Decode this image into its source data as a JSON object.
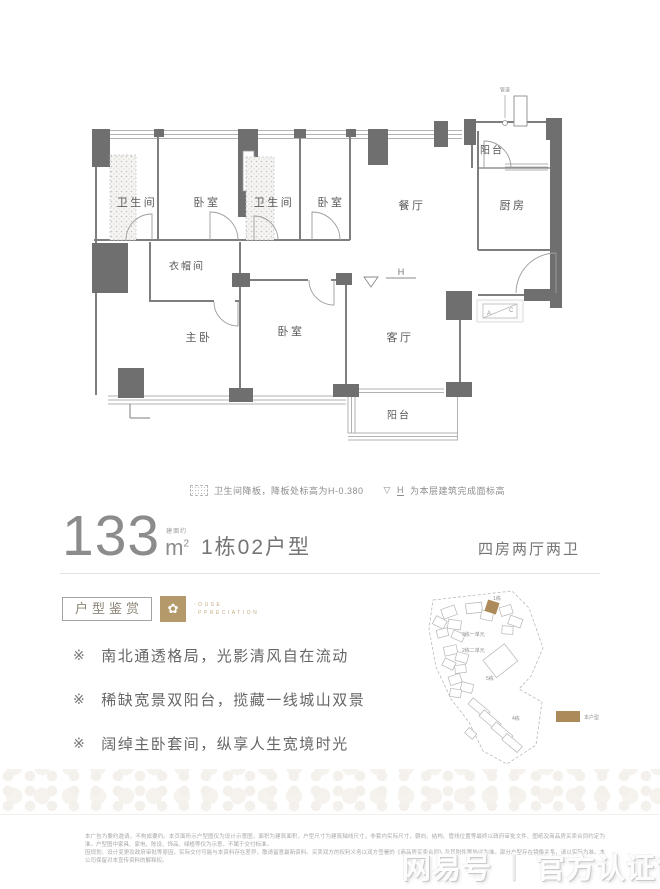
{
  "floorplan": {
    "rooms": [
      "卫生间",
      "卧室",
      "卫生间",
      "卧室",
      "餐厅",
      "厨房",
      "阳台",
      "衣帽间",
      "主卧",
      "卧室",
      "客厅",
      "阳台"
    ],
    "pipe_label": "管道",
    "h_label": "H",
    "ac_a": "A",
    "ac_c": "C",
    "legend": {
      "note1": "卫生间降板，降板处标高为H-0.380",
      "triangle_glyph": "▽",
      "note2_h": "H",
      "note2": "为本层建筑完成面标高"
    }
  },
  "title": {
    "area_value": "133",
    "area_prefix": "建面约",
    "area_unit": "m",
    "area_sup": "2",
    "unit_name": "1栋02户型",
    "layout": "四房两厅两卫"
  },
  "appreciation": {
    "badge": "户型鉴赏",
    "icon": "✿",
    "en_line1": "·OUSE",
    "en_line2": "·PPRECIATION"
  },
  "features": {
    "marker": "※",
    "items": [
      "南北通透格局，光影清风自在流动",
      "稀缺宽景双阳台，揽藏一线城山双景",
      "阔绰主卧套间，纵享人生宽境时光"
    ]
  },
  "sitemap": {
    "labels": [
      "1栋",
      "2栋一单元",
      "2栋二单元",
      "5栋",
      "4栋"
    ],
    "legend_label": "本户型",
    "highlight_color": "#ad8a59"
  },
  "disclaimer": {
    "line1": "本广告为要约邀请，不构成要约。本页面所示户型图仅为设计示意图，面积为建筑面积，户型尺寸为建筑轴线尺寸，非套内实际尺寸，朝向、结构、管线位置等最终以政府审批文件、图纸及商品房买卖合同约定为准。户型图中家具、家电、陈设、饰品、绿植等仅为示意，不属于交付标准。",
    "line2": "因规划、设计变更及政府审批等原因，实际交付可能与本资料存在差异，敬请留意最新资料。买卖双方的权利义务以双方签署的《商品房买卖合同》及其附件等协议为准。部分户型存在镜像关系，请以实际为准。本公司保留对本宣传资料的解释权。"
  },
  "watermark": {
    "brand": "网易号",
    "sep": "丨",
    "label": "官方认证售楼处"
  }
}
